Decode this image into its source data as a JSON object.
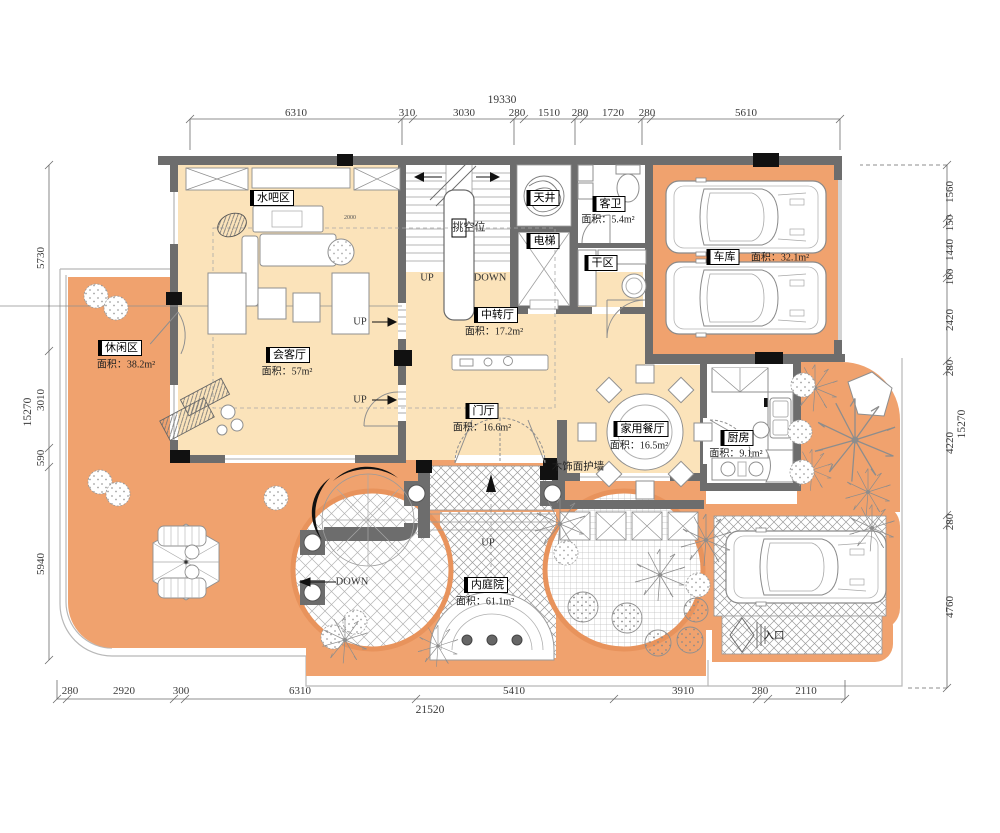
{
  "meta": {
    "kind": "residential-floor-plan",
    "floor_note": "first floor furniture layout"
  },
  "colors": {
    "terrace_orange": "#f0a26e",
    "room_cream": "#fbe3ba",
    "wall_gray": "#6d6d6d",
    "paving_edge": "#e8935c"
  },
  "rooms": {
    "shuiba": {
      "name": "水吧区"
    },
    "huiketing": {
      "name": "会客厅",
      "area": "面积：57m²"
    },
    "xiuxianqu": {
      "name": "休闲区",
      "area": "面积：38.2m²"
    },
    "zhongzhuanting": {
      "name": "中转厅",
      "area": "面积：17.2m²"
    },
    "menting": {
      "name": "门厅",
      "area": "面积：16.6m²"
    },
    "jiacanting": {
      "name": "家用餐厅",
      "area": "面积：16.5m²"
    },
    "chufang": {
      "name": "厨房",
      "area": "面积：9.1m²"
    },
    "cheku": {
      "name": "车库",
      "area": "面积：32.1m²"
    },
    "kewei": {
      "name": "客卫",
      "area": "面积：5.4m²"
    },
    "ganqu": {
      "name": "干区"
    },
    "dianti": {
      "name": "电梯"
    },
    "tianjing": {
      "name": "天井"
    },
    "neitingyuan": {
      "name": "内庭院",
      "area": "面积：61.1m²"
    },
    "tiaokongwei": {
      "name": "挑空位"
    }
  },
  "labels": {
    "up": "UP",
    "down": "DOWN",
    "entrance": "入口",
    "wood_wall": "木饰面护墙",
    "bar_dim": "2000"
  },
  "dims": {
    "top": {
      "total": "19330",
      "segments": [
        "6310",
        "310",
        "3030",
        "280",
        "1510",
        "280",
        "1720",
        "280",
        "5610"
      ]
    },
    "bottom": {
      "total": "21520",
      "segments": [
        "280",
        "2920",
        "300",
        "6310",
        "5410",
        "3910",
        "280",
        "2110"
      ]
    },
    "left": {
      "total": "15270",
      "segments": [
        "5730",
        "3010",
        "590",
        "5940"
      ]
    },
    "right": {
      "total": "15270",
      "segments": [
        "1560",
        "150",
        "1440",
        "160",
        "2420",
        "280",
        "4220",
        "280",
        "4760"
      ]
    }
  }
}
